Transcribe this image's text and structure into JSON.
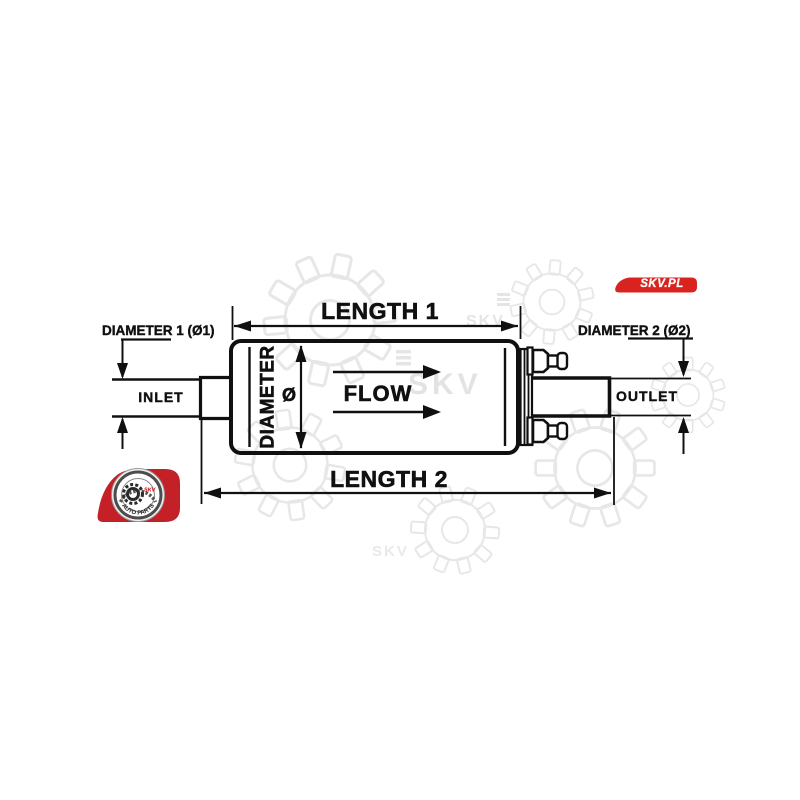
{
  "page": {
    "background_color": "#ffffff"
  },
  "brand": {
    "badge": {
      "label": "SKV.PL",
      "color": "#d9231f",
      "text_color": "#ffffff"
    },
    "logo": {
      "skv": "SKV",
      "auto_parts": "AUTO PARTS",
      "red": "#c32028"
    }
  },
  "watermark": {
    "text": "SKV",
    "color": "#e7e7e7"
  },
  "diagram": {
    "line_color": "#101010",
    "labels": {
      "length1": "LENGTH 1",
      "length2": "LENGTH 2",
      "diameter1": "DIAMETER 1 (Ø1)",
      "diameter2": "DIAMETER 2 (Ø2)",
      "diameter": "DIAMETER",
      "diameter_symbol": "Ø",
      "inlet": "INLET",
      "outlet": "OUTLET",
      "flow": "FLOW"
    }
  }
}
